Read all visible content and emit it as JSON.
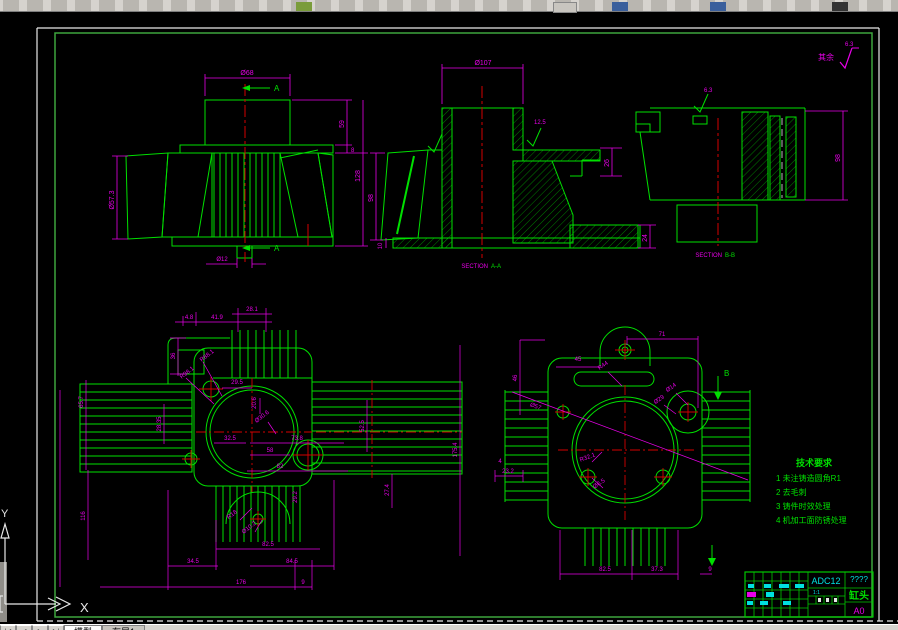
{
  "ui": {
    "tabs": {
      "nav": [
        "|◀",
        "◀",
        "▶",
        "▶|"
      ],
      "model": "模型",
      "layout1": "布局1"
    },
    "ucs": {
      "x_label": "X",
      "y_label": "Y"
    }
  },
  "drawing": {
    "roughness_note": {
      "prefix": "其余",
      "value": "6.3"
    },
    "tech_requirements": {
      "title": "技术要求",
      "items": [
        "1 未注铸造圆角R1",
        "2 去毛刺",
        "3 铸件时效处理",
        "4 机加工面防锈处理"
      ]
    },
    "title_block": {
      "material": "ADC12",
      "code": "????",
      "part_name": "缸头",
      "paper": "A0",
      "scale": "1:1"
    },
    "views": {
      "front": {
        "dim_top": "Ø68",
        "dim_right_upper": "59",
        "dim_right_small": "8",
        "dim_right_total": "128",
        "dim_left": "Ø57.3",
        "dim_bottom": "Ø12",
        "section_letter": "A"
      },
      "section_a": {
        "label_prefix": "SECTION",
        "label_letters": "A-A",
        "dim_top": "Ø107",
        "dim_left": "98",
        "dim_plate": "10",
        "dim_right": "26",
        "dim_foot": "24",
        "roughness": "12.5"
      },
      "section_b": {
        "label_prefix": "SECTION",
        "label_letters": "B-B",
        "dim_right": "98",
        "roughness": "6.3"
      },
      "top": {
        "dims": [
          "4.8",
          "41.9",
          "28.1",
          "36",
          "R88.1",
          "R98.1",
          "29.5",
          "20.6",
          "Ø30.6",
          "65.7",
          "28.35",
          "52.5",
          "175.4",
          "32.5",
          "73.8",
          "58",
          "82",
          "29.2",
          "27.4",
          "R18",
          "Ø10.2",
          "82.5",
          "34.5",
          "84.5",
          "176",
          "9",
          "116"
        ]
      },
      "bottom": {
        "dims": [
          "71",
          "45",
          "R44",
          "Ø14",
          "Ø29",
          "46",
          "Ø57",
          "R32.1",
          "Ø6.5",
          "23.2",
          "4",
          "82.5",
          "37.3",
          "9"
        ],
        "section_letter": "B"
      }
    }
  }
}
